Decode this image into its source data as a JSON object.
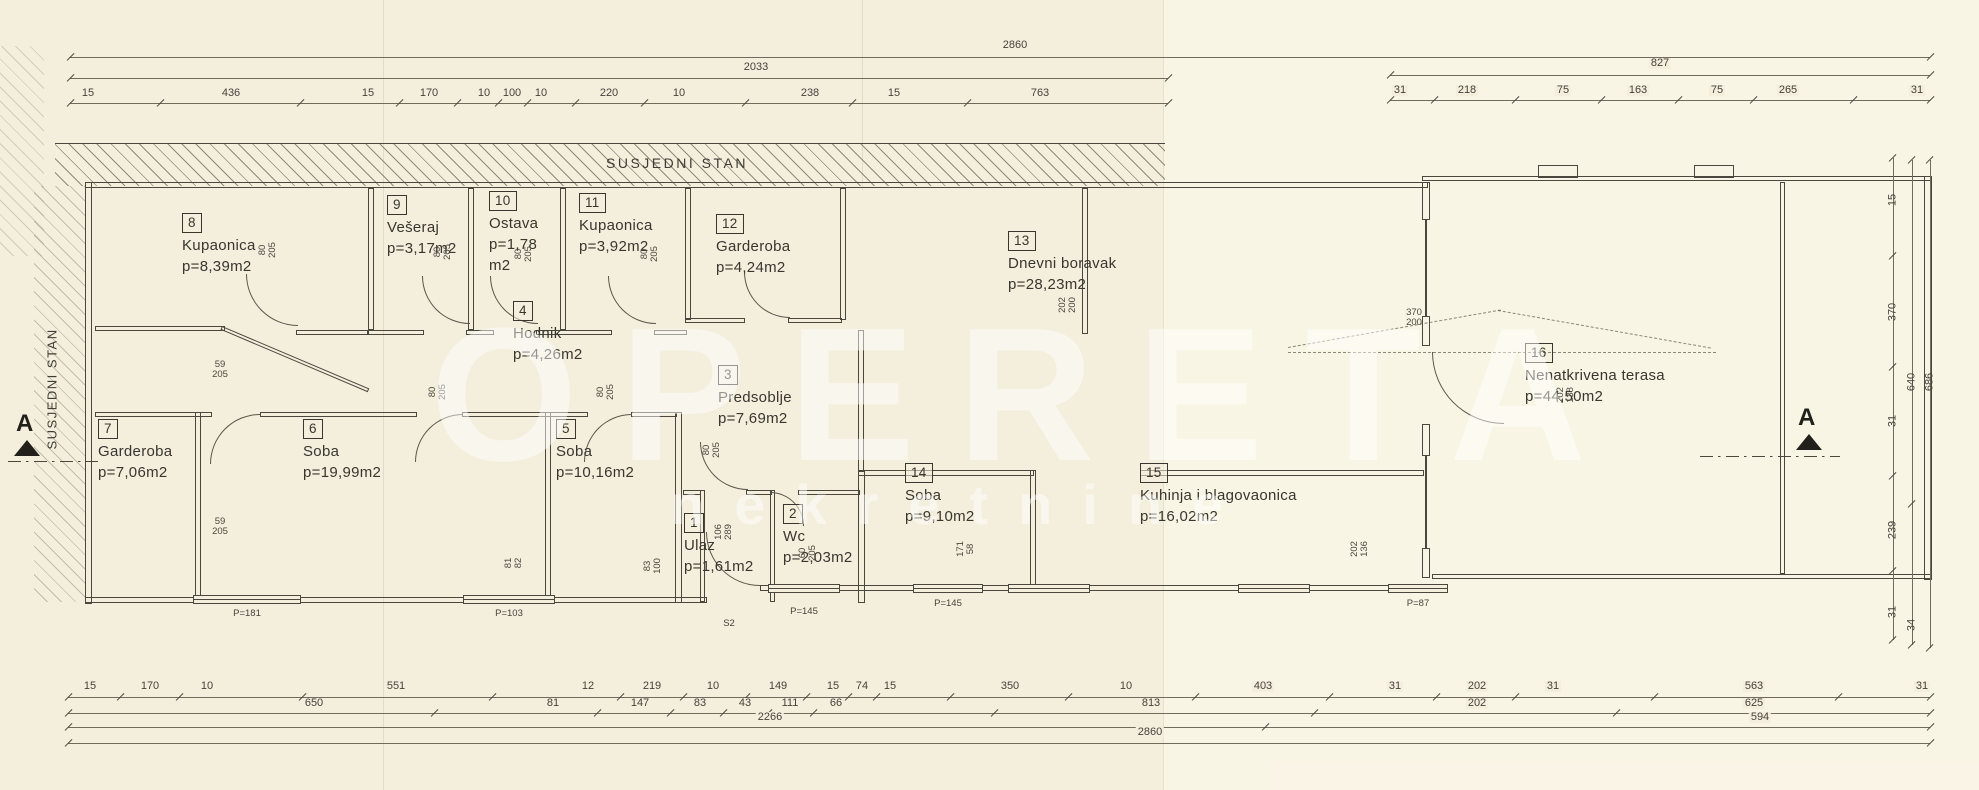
{
  "plan": {
    "neighbor_top": "SUSJEDNI STAN",
    "neighbor_left": "SUSJEDNI STAN"
  },
  "section": {
    "left": "A",
    "right": "A"
  },
  "watermark": {
    "line1": "OPERETA",
    "line2": "nekretnine"
  },
  "rooms": [
    {
      "number": "1",
      "name": "Ulaz",
      "area": "p=1,61m2",
      "x": 684,
      "y": 512,
      "w": 110
    },
    {
      "number": "2",
      "name": "Wc",
      "area": "p=2,03m2",
      "x": 783,
      "y": 503,
      "w": 110
    },
    {
      "number": "3",
      "name": "Predsoblje",
      "area": "p=7,69m2",
      "x": 718,
      "y": 364,
      "w": 150
    },
    {
      "number": "4",
      "name": "Hodnik",
      "area": "p=4,26m2",
      "x": 513,
      "y": 300,
      "w": 130
    },
    {
      "number": "5",
      "name": "Soba",
      "area": "p=10,16m2",
      "x": 556,
      "y": 418,
      "w": 130
    },
    {
      "number": "6",
      "name": "Soba",
      "area": "p=19,99m2",
      "x": 303,
      "y": 418,
      "w": 130
    },
    {
      "number": "7",
      "name": "Garderoba",
      "area": "p=7,06m2",
      "x": 98,
      "y": 418,
      "w": 130
    },
    {
      "number": "8",
      "name": "Kupaonica",
      "area": "p=8,39m2",
      "x": 182,
      "y": 212,
      "w": 140
    },
    {
      "number": "9",
      "name": "Vešeraj",
      "area": "p=3,17m2",
      "x": 387,
      "y": 194,
      "w": 110
    },
    {
      "number": "10",
      "name": "Ostava",
      "area": "p=1,78\nm2",
      "x": 489,
      "y": 190,
      "w": 64
    },
    {
      "number": "11",
      "name": "Kupaonica",
      "area": "p=3,92m2",
      "x": 579,
      "y": 192,
      "w": 130
    },
    {
      "number": "12",
      "name": "Garderoba",
      "area": "p=4,24m2",
      "x": 716,
      "y": 213,
      "w": 130
    },
    {
      "number": "13",
      "name": "Dnevni boravak",
      "area": "p=28,23m2",
      "x": 1008,
      "y": 230,
      "w": 180
    },
    {
      "number": "14",
      "name": "Soba",
      "area": "p=9,10m2",
      "x": 905,
      "y": 462,
      "w": 110
    },
    {
      "number": "15",
      "name": "Kuhinja i blagovaonica",
      "area": "p=16,02m2",
      "x": 1140,
      "y": 462,
      "w": 260
    },
    {
      "number": "16",
      "name": "Nenatkrivena terasa",
      "area": "p=44,50m2",
      "x": 1525,
      "y": 342,
      "w": 220
    }
  ],
  "door_dims": [
    {
      "a": "80",
      "b": "205",
      "x": 268,
      "y": 250,
      "rot": true
    },
    {
      "a": "80",
      "b": "205",
      "x": 443,
      "y": 252,
      "rot": true
    },
    {
      "a": "80",
      "b": "205",
      "x": 524,
      "y": 254,
      "rot": true
    },
    {
      "a": "80",
      "b": "205",
      "x": 650,
      "y": 254,
      "rot": true
    },
    {
      "a": "80",
      "b": "205",
      "x": 438,
      "y": 392,
      "rot": true
    },
    {
      "a": "80",
      "b": "205",
      "x": 606,
      "y": 392,
      "rot": true
    },
    {
      "a": "80",
      "b": "205",
      "x": 712,
      "y": 450,
      "rot": true
    },
    {
      "a": "59",
      "b": "205",
      "x": 220,
      "y": 370,
      "rot": false
    },
    {
      "a": "59",
      "b": "205",
      "x": 220,
      "y": 527,
      "rot": false
    },
    {
      "a": "106",
      "b": "289",
      "x": 724,
      "y": 532,
      "rot": true
    },
    {
      "a": "83",
      "b": "100",
      "x": 653,
      "y": 566,
      "rot": true
    },
    {
      "a": "81",
      "b": "82",
      "x": 514,
      "y": 563,
      "rot": true
    },
    {
      "a": "60",
      "b": "205",
      "x": 808,
      "y": 553,
      "rot": true
    },
    {
      "a": "171",
      "b": "58",
      "x": 966,
      "y": 549,
      "rot": true
    },
    {
      "a": "202",
      "b": "136",
      "x": 1360,
      "y": 549,
      "rot": true
    },
    {
      "a": "202",
      "b": "138",
      "x": 1566,
      "y": 395,
      "rot": true
    },
    {
      "a": "202",
      "b": "200",
      "x": 1068,
      "y": 305,
      "rot": true
    },
    {
      "a": "370",
      "b": "200",
      "x": 1414,
      "y": 318,
      "rot": false
    }
  ],
  "window_labels": [
    {
      "t": "P=181",
      "x": 247,
      "y": 608
    },
    {
      "t": "P=103",
      "x": 509,
      "y": 608
    },
    {
      "t": "S2",
      "x": 729,
      "y": 618
    },
    {
      "t": "P=145",
      "x": 804,
      "y": 606
    },
    {
      "t": "P=145",
      "x": 948,
      "y": 598
    },
    {
      "t": "P=87",
      "x": 1418,
      "y": 598
    }
  ],
  "top_dim_rows": [
    {
      "label_y": 40,
      "line_y": 57,
      "x1": 70,
      "x2": 1930,
      "labels": [
        {
          "v": "2860",
          "x": 1015
        }
      ]
    },
    {
      "label_y": 62,
      "line_y": 78,
      "x1": 70,
      "x2": 1168,
      "labels": [
        {
          "v": "2033",
          "x": 756
        }
      ]
    },
    {
      "label_y": 58,
      "line_y": 75,
      "x1": 1390,
      "x2": 1930,
      "labels": [
        {
          "v": "827",
          "x": 1660
        }
      ]
    },
    {
      "label_y": 88,
      "line_y": 103,
      "x1": 70,
      "x2": 1168,
      "labels": [
        {
          "v": "15",
          "x": 88
        },
        {
          "v": "436",
          "x": 231
        },
        {
          "v": "15",
          "x": 368
        },
        {
          "v": "170",
          "x": 429
        },
        {
          "v": "10",
          "x": 484
        },
        {
          "v": "100",
          "x": 512
        },
        {
          "v": "10",
          "x": 541
        },
        {
          "v": "220",
          "x": 609
        },
        {
          "v": "10",
          "x": 679
        },
        {
          "v": "238",
          "x": 810
        },
        {
          "v": "15",
          "x": 894
        },
        {
          "v": "763",
          "x": 1040
        }
      ]
    },
    {
      "label_y": 85,
      "line_y": 100,
      "x1": 1390,
      "x2": 1930,
      "labels": [
        {
          "v": "31",
          "x": 1400
        },
        {
          "v": "218",
          "x": 1467
        },
        {
          "v": "75",
          "x": 1563
        },
        {
          "v": "163",
          "x": 1638
        },
        {
          "v": "75",
          "x": 1717
        },
        {
          "v": "265",
          "x": 1788
        },
        {
          "v": "31",
          "x": 1917
        }
      ]
    }
  ],
  "bottom_dim_rows": [
    {
      "label_y": 681,
      "line_y": 697,
      "x1": 68,
      "x2": 1930,
      "labels": [
        {
          "v": "15",
          "x": 90
        },
        {
          "v": "170",
          "x": 150
        },
        {
          "v": "10",
          "x": 207
        },
        {
          "v": "551",
          "x": 396
        },
        {
          "v": "12",
          "x": 588
        },
        {
          "v": "219",
          "x": 652
        },
        {
          "v": "10",
          "x": 713
        },
        {
          "v": "149",
          "x": 778
        },
        {
          "v": "15",
          "x": 833
        },
        {
          "v": "74",
          "x": 862
        },
        {
          "v": "15",
          "x": 890
        },
        {
          "v": "350",
          "x": 1010
        },
        {
          "v": "10",
          "x": 1126
        },
        {
          "v": "403",
          "x": 1263
        },
        {
          "v": "31",
          "x": 1395
        },
        {
          "v": "202",
          "x": 1477
        },
        {
          "v": "31",
          "x": 1553
        },
        {
          "v": "563",
          "x": 1754
        },
        {
          "v": "31",
          "x": 1922
        }
      ]
    },
    {
      "label_y": 698,
      "line_y": 713,
      "x1": 68,
      "x2": 1930,
      "labels": [
        {
          "v": "650",
          "x": 314
        },
        {
          "v": "81",
          "x": 553
        },
        {
          "v": "147",
          "x": 640
        },
        {
          "v": "83",
          "x": 700
        },
        {
          "v": "43",
          "x": 745
        },
        {
          "v": "111",
          "x": 790
        },
        {
          "v": "66",
          "x": 836
        },
        {
          "v": "813",
          "x": 1151
        },
        {
          "v": "202",
          "x": 1477
        },
        {
          "v": "625",
          "x": 1754
        }
      ]
    },
    {
      "label_y": 712,
      "line_y": 727,
      "x1": 68,
      "x2": 1930,
      "labels": [
        {
          "v": "2266",
          "x": 770
        },
        {
          "v": "594",
          "x": 1760
        }
      ]
    },
    {
      "label_y": 727,
      "line_y": 743,
      "x1": 68,
      "x2": 1930,
      "labels": [
        {
          "v": "2860",
          "x": 1150
        }
      ]
    }
  ],
  "right_dim_cols": [
    {
      "x": 1893,
      "y1": 158,
      "y2": 640,
      "labels": [
        {
          "v": "15",
          "y": 200
        },
        {
          "v": "370",
          "y": 312
        },
        {
          "v": "31",
          "y": 421
        },
        {
          "v": "239",
          "y": 530
        },
        {
          "v": "31",
          "y": 612
        }
      ]
    },
    {
      "x": 1912,
      "y1": 160,
      "y2": 645,
      "labels": [
        {
          "v": "640",
          "y": 382
        },
        {
          "v": "34",
          "y": 625
        }
      ]
    },
    {
      "x": 1930,
      "y1": 160,
      "y2": 648,
      "labels": [
        {
          "v": "686",
          "y": 382
        }
      ]
    }
  ]
}
